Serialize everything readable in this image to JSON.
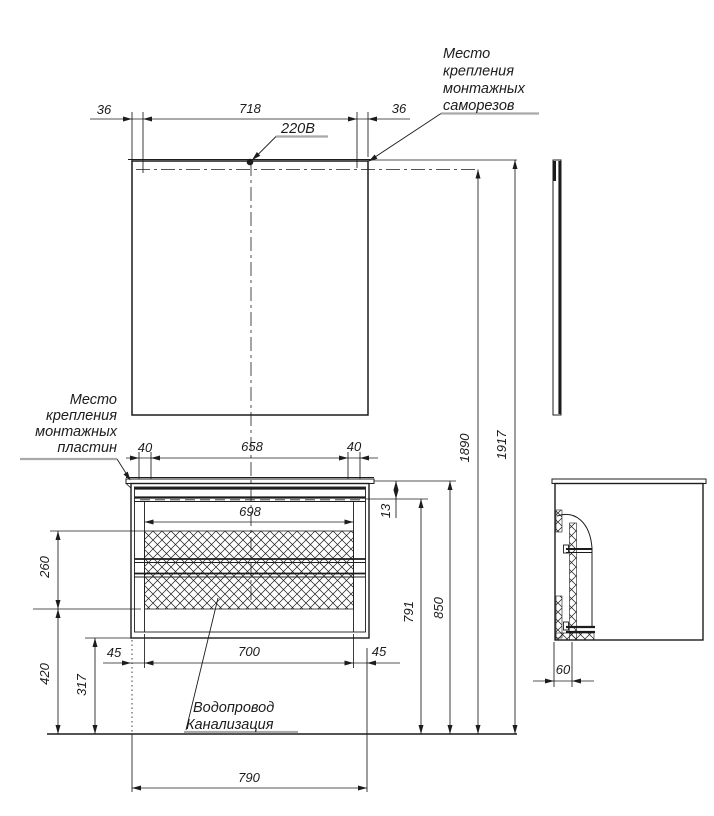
{
  "drawing": {
    "background_color": "#ffffff",
    "line_color": "#1c1c1c",
    "leader_underline_color": "#a9a9a9"
  },
  "labels": {
    "screws_note": [
      "Место",
      "крепления",
      "монтажных",
      "саморезов"
    ],
    "plates_note": [
      "Место",
      "крепления",
      "монтажных",
      "пластин"
    ],
    "power_note": "220В",
    "plumbing_note": [
      "Водопровод",
      "Канализация"
    ]
  },
  "dims": {
    "mirror_left_margin": "36",
    "mirror_screw_span": "718",
    "mirror_right_margin": "36",
    "plate_left_offset": "40",
    "plate_span": "658",
    "plate_right_offset": "40",
    "opening_width": "698",
    "top_rail_height": "13",
    "rail_line_height": "791",
    "countertop_height": "850",
    "mount_line_height": "1890",
    "mirror_top_height": "1917",
    "hatch_height": "260",
    "hatch_to_floor": "420",
    "cabinet_bottom_to_floor": "317",
    "left_side_margin": "45",
    "hatch_width": "700",
    "right_side_margin": "45",
    "overall_width": "790",
    "side_wall_offset": "60"
  }
}
